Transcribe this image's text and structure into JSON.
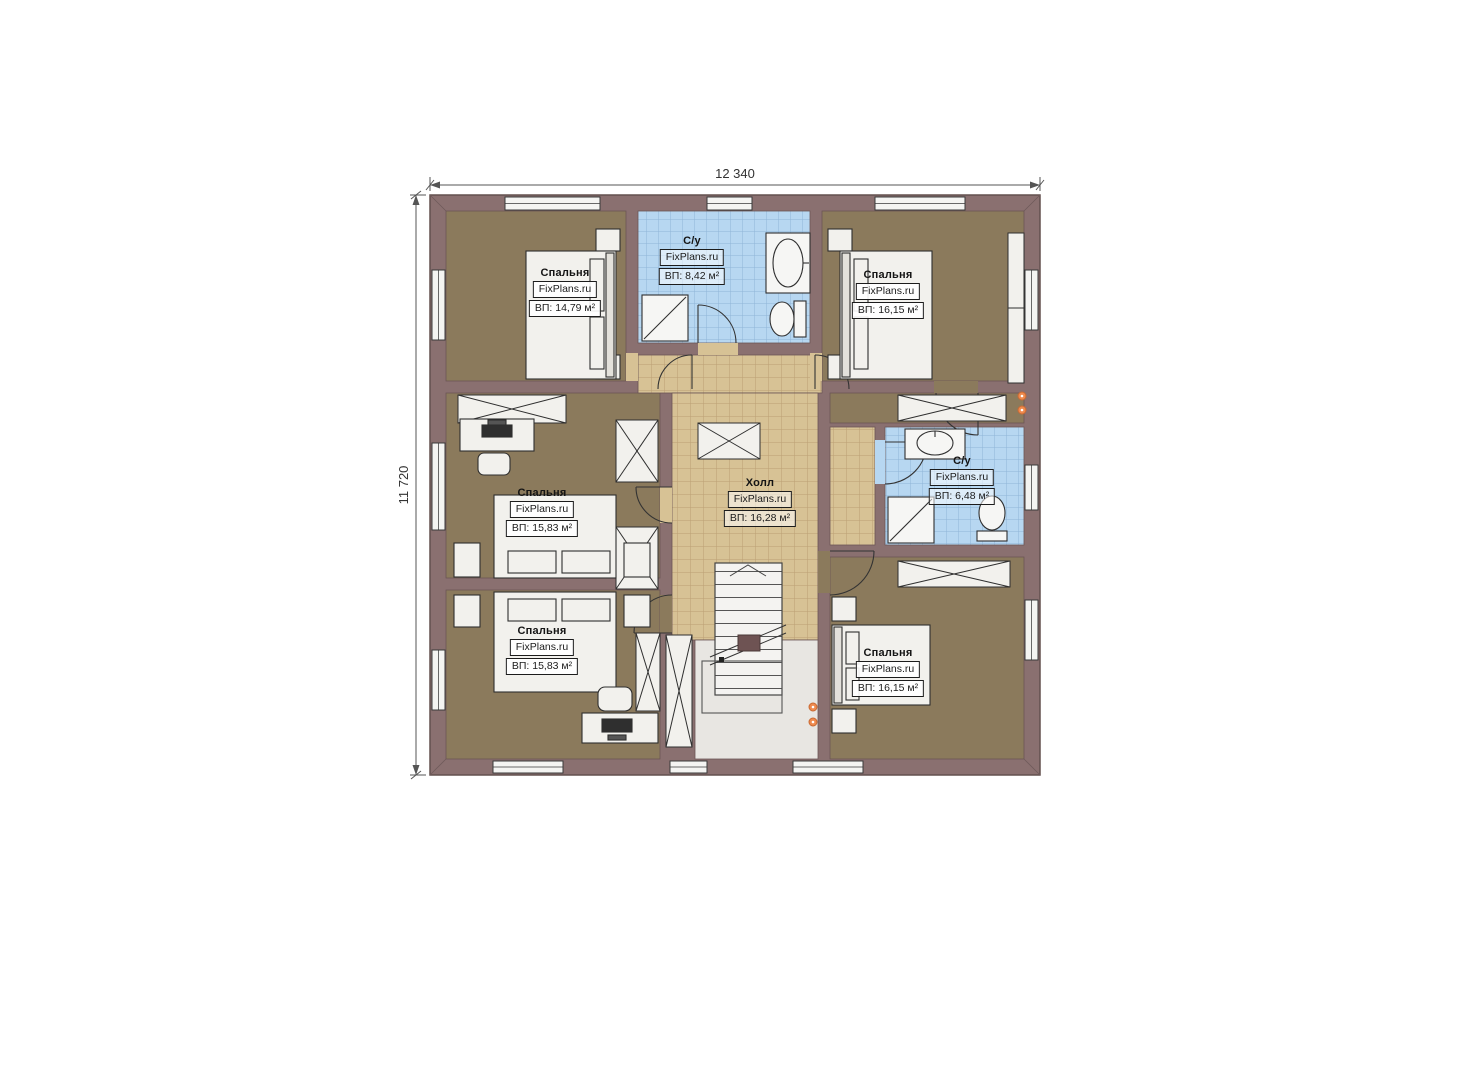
{
  "page": {
    "background": "#ffffff",
    "type": "floor-plan"
  },
  "plan": {
    "dimensions": {
      "top": "12 340",
      "left": "11 720"
    },
    "watermark": "FixPlans.ru",
    "rooms": [
      {
        "id": "bedroom-top-left",
        "name": "Спальня",
        "watermark": "FixPlans.ru",
        "area": "ВП: 14,79 м²"
      },
      {
        "id": "bathroom-top",
        "name": "С/у",
        "watermark": "FixPlans.ru",
        "area": "ВП: 8,42 м²"
      },
      {
        "id": "bedroom-top-right",
        "name": "Спальня",
        "watermark": "FixPlans.ru",
        "area": "ВП: 16,15 м²"
      },
      {
        "id": "bedroom-middle-left",
        "name": "Спальня",
        "watermark": "FixPlans.ru",
        "area": "ВП: 15,83 м²"
      },
      {
        "id": "hall",
        "name": "Холл",
        "watermark": "FixPlans.ru",
        "area": "ВП: 16,28 м²"
      },
      {
        "id": "bathroom-right",
        "name": "С/у",
        "watermark": "FixPlans.ru",
        "area": "ВП: 6,48 м²"
      },
      {
        "id": "bedroom-bottom-left",
        "name": "Спальня",
        "watermark": "FixPlans.ru",
        "area": "ВП: 15,83 м²"
      },
      {
        "id": "bedroom-bottom-right",
        "name": "Спальня",
        "watermark": "FixPlans.ru",
        "area": "ВП: 16,15 м²"
      }
    ],
    "colors": {
      "wall": "#8a7070",
      "wall_edge": "#63504f",
      "bedroom_floor": "#8b7a5c",
      "bathroom_tile": "#b7d7f1",
      "bathroom_grid": "#8fb4d8",
      "hall_tile": "#d7c295",
      "hall_grid": "#bb9f74",
      "furniture_fill": "#f2f1ed",
      "furniture_line": "#2f2f2f",
      "accent_orange": "#ef8a4e",
      "dimension_line": "#555555"
    }
  }
}
